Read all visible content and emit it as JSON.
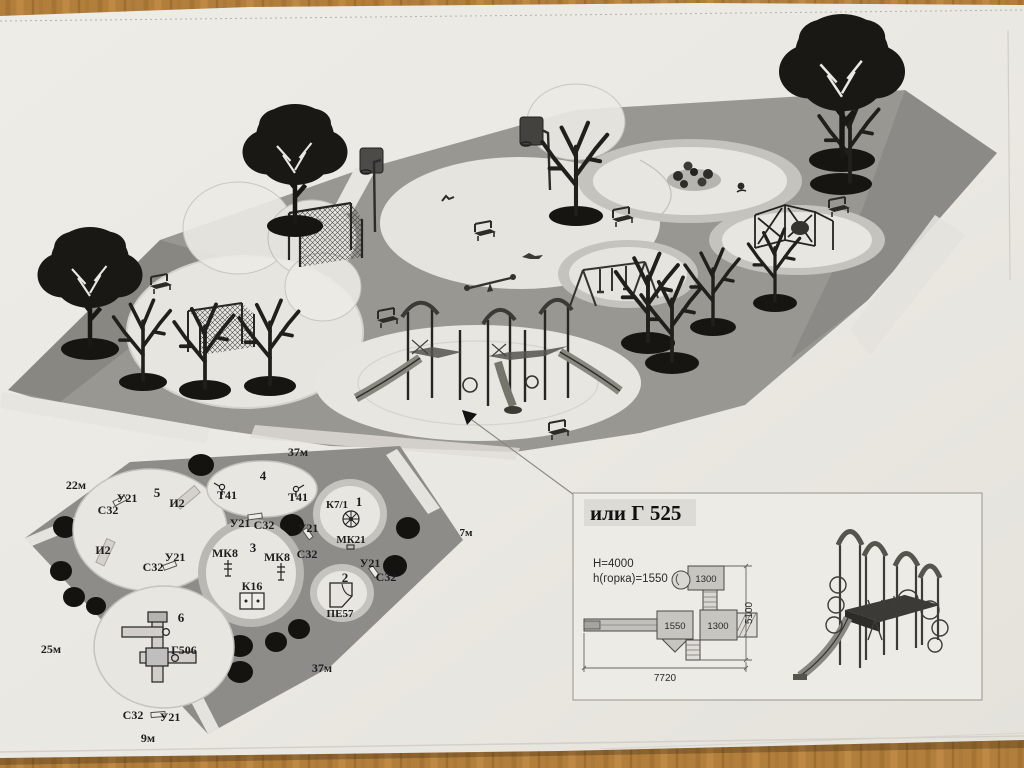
{
  "colors": {
    "desk_wood": "#b5813c",
    "paper": "#f0efea",
    "iso_site_gray": "#9b9a96",
    "plan_site_gray": "#8f8f8c",
    "zone_light": "#edece8",
    "tree_black": "#161616",
    "ring_gray": "#c7c6c2"
  },
  "plan_2d": {
    "site_dimensions": {
      "top": "37м",
      "left_upper": "22м",
      "left_lower": "25м",
      "bottom": "9м",
      "bottom_right": "37м",
      "right": "7м"
    },
    "zone_numbers": {
      "z1": "1",
      "z2": "2",
      "z3": "3",
      "z4": "4",
      "z5": "5",
      "z6": "6"
    },
    "equipment_codes": {
      "u21": "У21",
      "s32": "С32",
      "i2": "И2",
      "t41": "Т41",
      "mk8": "МК8",
      "k16": "К16",
      "k7_1": "К7/1",
      "mk21": "МК21",
      "pe57": "ПЕ57",
      "g506": "Г506"
    }
  },
  "detail_callout": {
    "title": "или Г 525",
    "specs": {
      "overall_height": "Н=4000",
      "slide_height": "h(горка)=1550"
    },
    "dimensions": {
      "module_top": "1300",
      "module_left": "1550",
      "module_center": "1300",
      "depth": "5100",
      "width": "7720"
    }
  }
}
